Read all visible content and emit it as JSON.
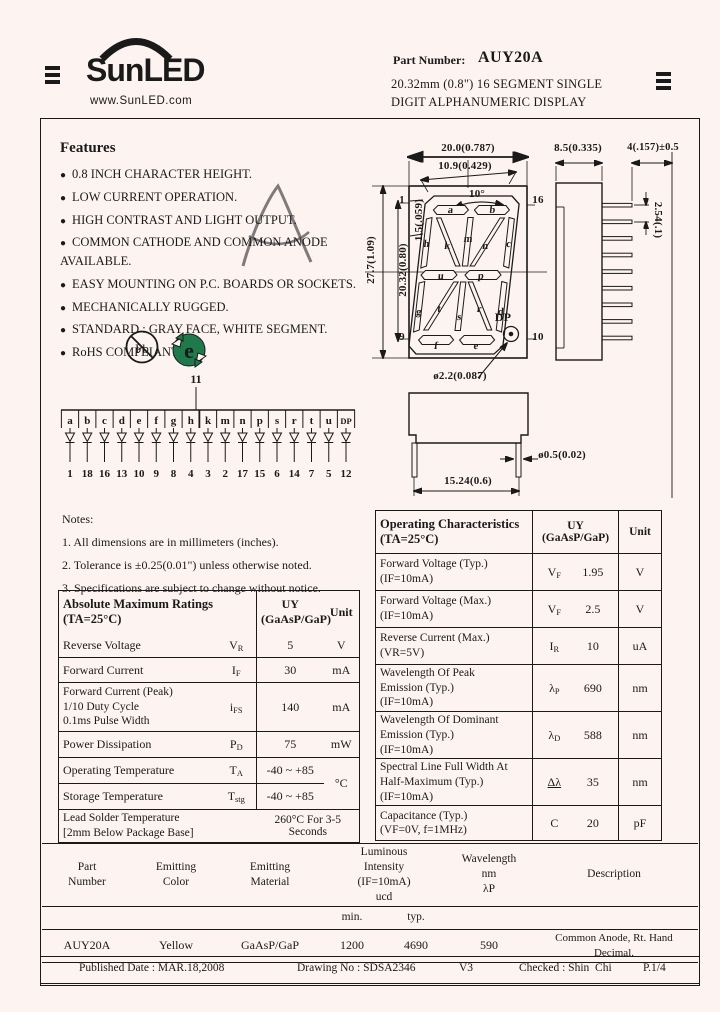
{
  "header": {
    "brand": "SunLED",
    "website": "www.SunLED.com",
    "part_number_label": "Part Number:",
    "part_number": "AUY20A",
    "description_line1": "20.32mm (0.8\") 16 SEGMENT SINGLE",
    "description_line2": "DIGIT ALPHANUMERIC DISPLAY"
  },
  "features": {
    "title": "Features",
    "items": [
      "0.8 INCH CHARACTER HEIGHT.",
      "LOW CURRENT OPERATION.",
      "HIGH CONTRAST AND LIGHT OUTPUT.",
      "COMMON CATHODE AND COMMON ANODE AVAILABLE.",
      "EASY MOUNTING ON P.C. BOARDS OR SOCKETS.",
      "MECHANICALLY RUGGED.",
      "STANDARD : GRAY FACE, WHITE SEGMENT.",
      "RoHS COMPLIANT."
    ]
  },
  "compliance": {
    "pb_icon": "Pb",
    "e_icon": "e"
  },
  "drawing": {
    "dims": {
      "top_width": "20.0(0.787)",
      "inner_width": "10.9(0.429)",
      "angle": "10°",
      "seg_thickness": "1.5(.059)",
      "inner_height": "20.32(0.80)",
      "outer_height": "27.7(1.09)",
      "pin_top_left": "1",
      "pin_bottom_left": "9",
      "pin_top_right": "16",
      "pin_bottom_right": "10",
      "dp_label": "DP",
      "dp_diameter": "ø2.2(0.087)",
      "side_width": "8.5(0.335)",
      "pin_length": "4(.157)±0.5",
      "pin_pitch": "2.54(.1)",
      "bottom_width": "15.24(0.6)",
      "pin_diameter": "ø0.5(0.02)"
    },
    "segment_labels": [
      "a",
      "b",
      "h",
      "k",
      "m",
      "n",
      "c",
      "u",
      "p",
      "g",
      "t",
      "s",
      "r",
      "d",
      "f",
      "e"
    ]
  },
  "pin_diagram": {
    "common_pin": "11",
    "segments": [
      "a",
      "b",
      "c",
      "d",
      "e",
      "f",
      "g",
      "h",
      "k",
      "m",
      "n",
      "p",
      "s",
      "r",
      "t",
      "u",
      "DP"
    ],
    "pins": [
      "1",
      "18",
      "16",
      "13",
      "10",
      "9",
      "8",
      "4",
      "3",
      "2",
      "17",
      "15",
      "6",
      "14",
      "7",
      "5",
      "12"
    ]
  },
  "notes": {
    "title": "Notes:",
    "items": [
      "1. All dimensions are in millimeters (inches).",
      "2. Tolerance is ±0.25(0.01\") unless otherwise noted.",
      "3. Specifications are subject to change without notice."
    ]
  },
  "abs_max": {
    "title": "Absolute Maximum Ratings\n(TA=25°C)",
    "col_value": "UY\n(GaAsP/GaP)",
    "col_unit": "Unit",
    "rows": [
      {
        "param": "Reverse Voltage",
        "sym_main": "V",
        "sym_sub": "R",
        "value": "5",
        "unit": "V"
      },
      {
        "param": "Forward Current",
        "sym_main": "I",
        "sym_sub": "F",
        "value": "30",
        "unit": "mA"
      },
      {
        "param": "Forward Current (Peak)\n1/10 Duty Cycle\n0.1ms Pulse Width",
        "sym_main": "i",
        "sym_sub": "FS",
        "value": "140",
        "unit": "mA"
      },
      {
        "param": "Power Dissipation",
        "sym_main": "P",
        "sym_sub": "D",
        "value": "75",
        "unit": "mW"
      },
      {
        "param": "Operating Temperature",
        "sym_main": "T",
        "sym_sub": "A",
        "value": "-40 ~ +85",
        "unit": "°C"
      },
      {
        "param": "Storage Temperature",
        "sym_main": "T",
        "sym_sub": "stg",
        "value": "-40 ~ +85",
        "unit": ""
      }
    ],
    "solder_label": "Lead Solder Temperature\n[2mm Below Package Base]",
    "solder_value": "260°C  For 3-5 Seconds"
  },
  "op_char": {
    "title": "Operating Characteristics\n(TA=25°C)",
    "col_value": "UY\n(GaAsP/GaP)",
    "col_unit": "Unit",
    "rows": [
      {
        "param": "Forward Voltage (Typ.)\n(IF=10mA)",
        "sym_main": "V",
        "sym_sub": "F",
        "value": "1.95",
        "unit": "V"
      },
      {
        "param": "Forward Voltage (Max.)\n(IF=10mA)",
        "sym_main": "V",
        "sym_sub": "F",
        "value": "2.5",
        "unit": "V"
      },
      {
        "param": "Reverse Current (Max.)\n(VR=5V)",
        "sym_main": "I",
        "sym_sub": "R",
        "value": "10",
        "unit": "uA"
      },
      {
        "param": "Wavelength Of Peak\nEmission (Typ.)\n(IF=10mA)",
        "sym_main": "λ",
        "sym_sub": "P",
        "value": "690",
        "unit": "nm"
      },
      {
        "param": "Wavelength Of Dominant\nEmission (Typ.)\n(IF=10mA)",
        "sym_main": "λ",
        "sym_sub": "D",
        "value": "588",
        "unit": "nm"
      },
      {
        "param": "Spectral Line Full Width At\nHalf-Maximum (Typ.)\n(IF=10mA)",
        "sym_main": "Δλ",
        "sym_sub": "",
        "value": "35",
        "unit": "nm"
      },
      {
        "param": "Capacitance (Typ.)\n(VF=0V, f=1MHz)",
        "sym_main": "C",
        "sym_sub": "",
        "value": "20",
        "unit": "pF"
      }
    ]
  },
  "summary_table": {
    "headers": {
      "part": "Part\nNumber",
      "color": "Emitting\nColor",
      "material": "Emitting\nMaterial",
      "intensity": "Luminous\nIntensity\n(IF=10mA)\nucd",
      "wavelength": "Wavelength\nnm\nλP",
      "description": "Description"
    },
    "sub_min": "min.",
    "sub_typ": "typ.",
    "row": {
      "part": "AUY20A",
      "color": "Yellow",
      "material": "GaAsP/GaP",
      "iv_min": "1200",
      "iv_typ": "4690",
      "wavelength": "590",
      "description": "Common Anode, Rt. Hand Decimal."
    }
  },
  "footer": {
    "published": "Published Date : MAR.18,2008",
    "drawing_no": "Drawing No : SDSA2346",
    "version": "V3",
    "checked": "Checked : Shin  Chi",
    "page": "P.1/4"
  },
  "colors": {
    "ink": "#1a1a1a",
    "page_bg": "#fdf3f0",
    "rohs_green": "#1e7a4b",
    "watermark": "#e9b0b0"
  }
}
